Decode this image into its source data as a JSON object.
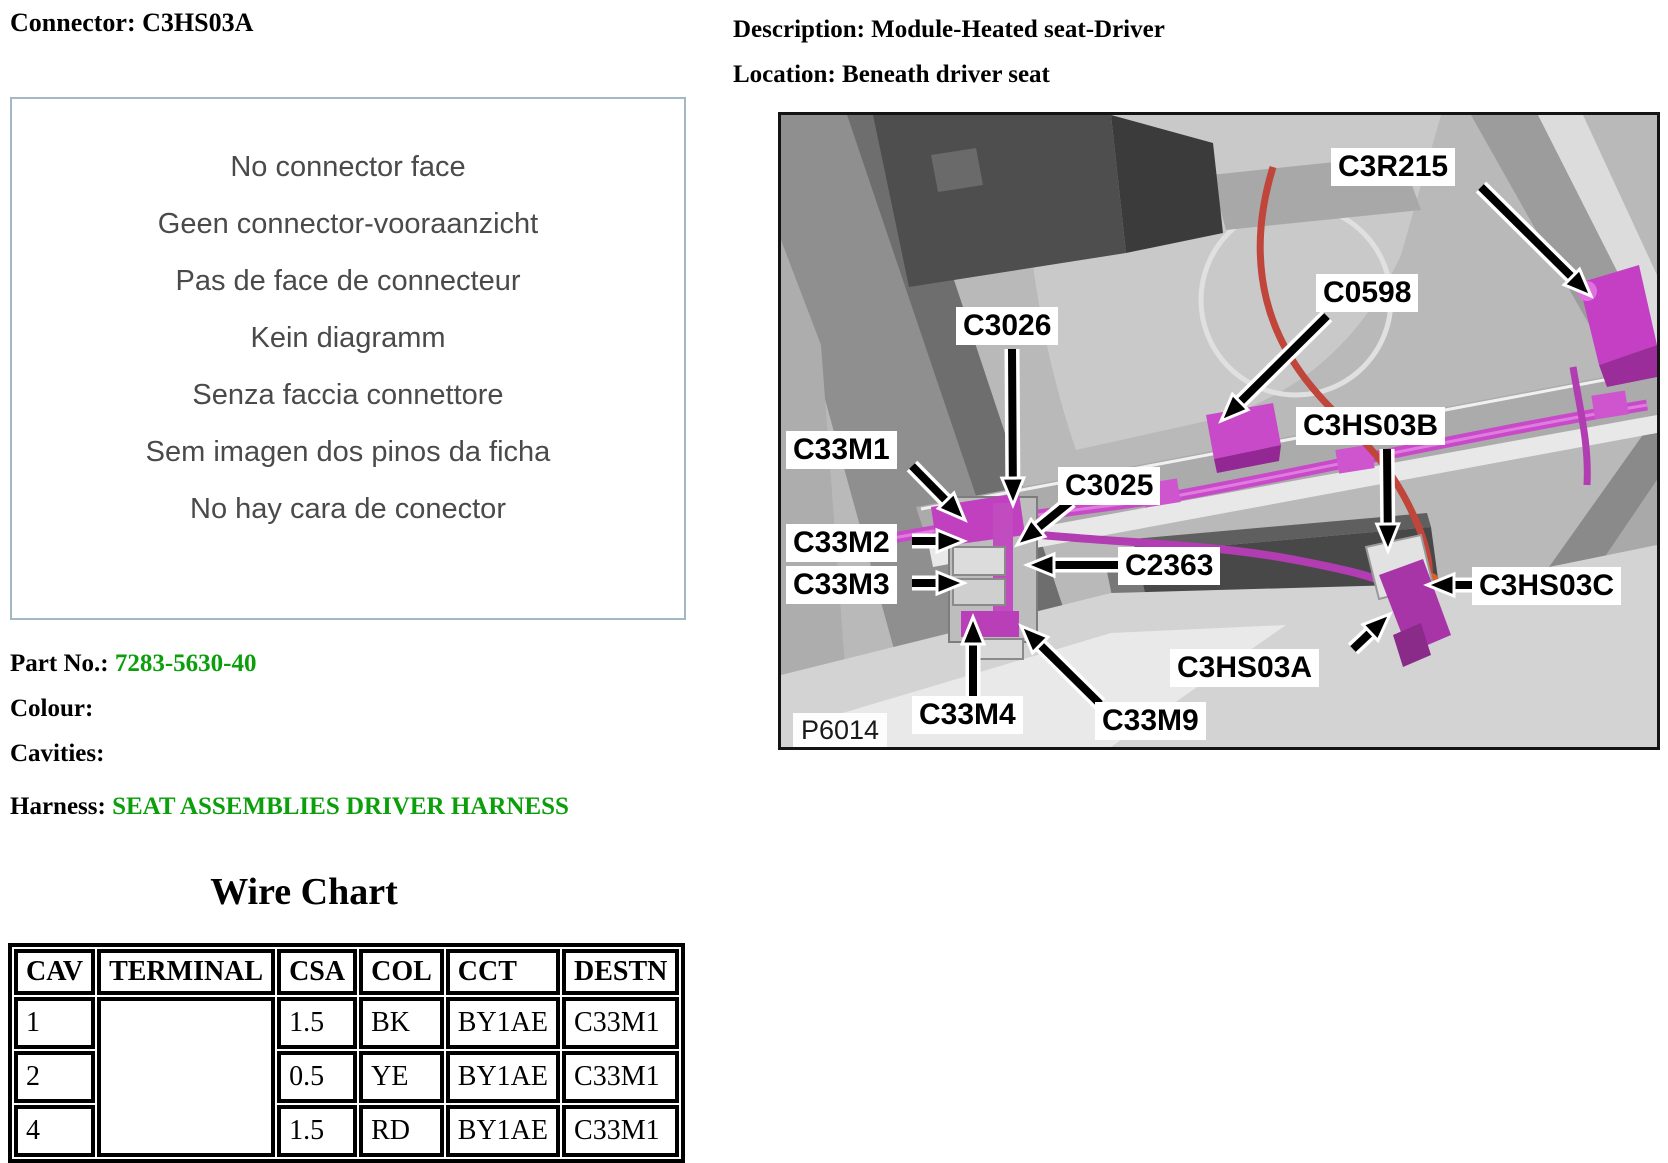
{
  "left": {
    "title": "Connector: C3HS03A",
    "no_face_lines": [
      "No connector face",
      "Geen connector-vooraanzicht",
      "Pas de face de connecteur",
      "Kein diagramm",
      "Senza faccia connettore",
      "Sem imagen dos pinos da ficha",
      "No hay cara de conector"
    ],
    "part_no_label": "Part No.:",
    "part_no_value": "7283-5630-40",
    "colour_label": "Colour:",
    "cavities_label": "Cavities:",
    "harness_label": "Harness:",
    "harness_value": "SEAT ASSEMBLIES DRIVER HARNESS",
    "link_color": "#0b9f0b"
  },
  "right": {
    "description_label": "Description:",
    "description_value": "Module-Heated seat-Driver",
    "location_label": "Location:",
    "location_value": "Beneath driver seat"
  },
  "photo": {
    "figure_code": "P6014",
    "callouts": [
      {
        "label": "C3026"
      },
      {
        "label": "C3R215"
      },
      {
        "label": "C0598"
      },
      {
        "label": "C33M1"
      },
      {
        "label": "C3025"
      },
      {
        "label": "C33M2"
      },
      {
        "label": "C2363"
      },
      {
        "label": "C33M3"
      },
      {
        "label": "C3HS03B"
      },
      {
        "label": "C3HS03C"
      },
      {
        "label": "C3HS03A"
      },
      {
        "label": "C33M4"
      },
      {
        "label": "C33M9"
      }
    ],
    "harness_color": "#c94ac9",
    "red_wire_color": "#c0453a"
  },
  "wire_chart": {
    "title": "Wire Chart",
    "columns": [
      "CAV",
      "TERMINAL",
      "CSA",
      "COL",
      "CCT",
      "DESTN"
    ],
    "rows": [
      {
        "cav": "1",
        "terminal": "",
        "csa": "1.5",
        "col": "BK",
        "cct": "BY1AE",
        "destn": "C33M1"
      },
      {
        "cav": "2",
        "terminal": "",
        "csa": "0.5",
        "col": "YE",
        "cct": "BY1AE",
        "destn": "C33M1"
      },
      {
        "cav": "4",
        "terminal": "",
        "csa": "1.5",
        "col": "RD",
        "cct": "BY1AE",
        "destn": "C33M1"
      }
    ]
  }
}
